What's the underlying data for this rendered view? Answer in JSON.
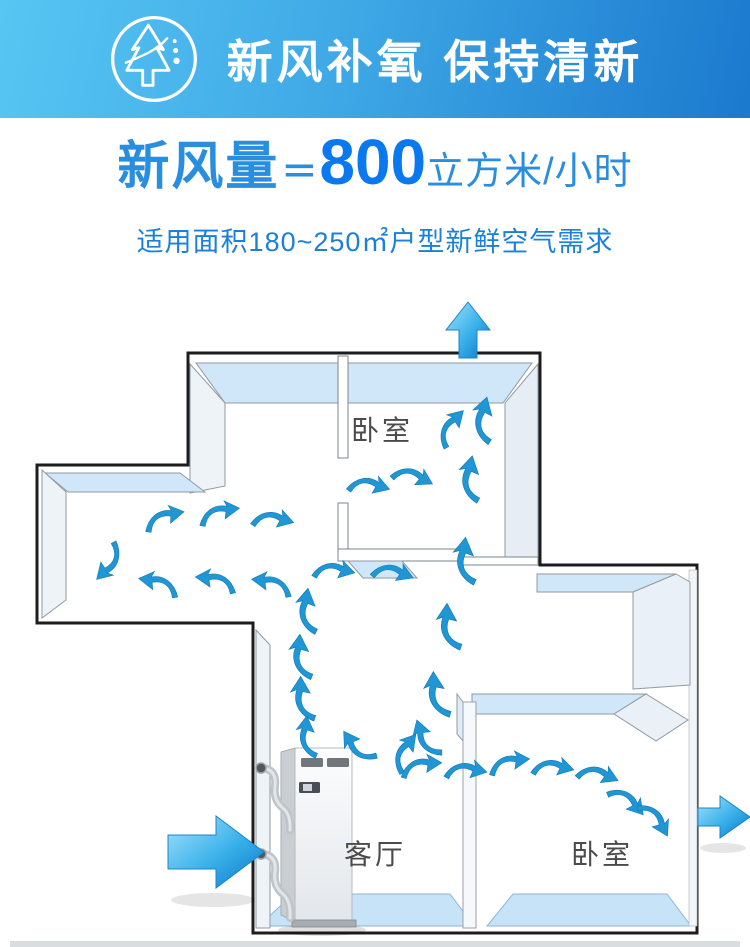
{
  "banner": {
    "title": "新风补氧 保持清新",
    "icon": "tree-fresh-air-icon",
    "bg_gradient_start": "#57c6f3",
    "bg_gradient_end": "#1b79ce",
    "text_color": "#ffffff"
  },
  "headline": {
    "label": "新风量",
    "equals": "＝",
    "value": "800",
    "unit": "立方米/小时",
    "label_color": "#2a8edf",
    "value_color": "#0a78ee"
  },
  "subtitle": {
    "text": "适用面积180~250㎡户型新鲜空气需求",
    "color": "#1a80dc"
  },
  "floor_plan": {
    "rooms": [
      {
        "label": "卧室"
      },
      {
        "label": "客厅"
      },
      {
        "label": "卧室"
      }
    ],
    "airflow_color": "#2196d4",
    "wall_top_color": "#cfe7f9",
    "wall_face_color": "#edf1f6",
    "floor_color": "#c7e3f7",
    "arrow_icons": {
      "intake_left": "fresh-air-in-arrow",
      "exhaust_top": "exhaust-up-arrow",
      "exhaust_right": "exhaust-right-arrow",
      "flow": "airflow-swoosh-icon"
    }
  }
}
